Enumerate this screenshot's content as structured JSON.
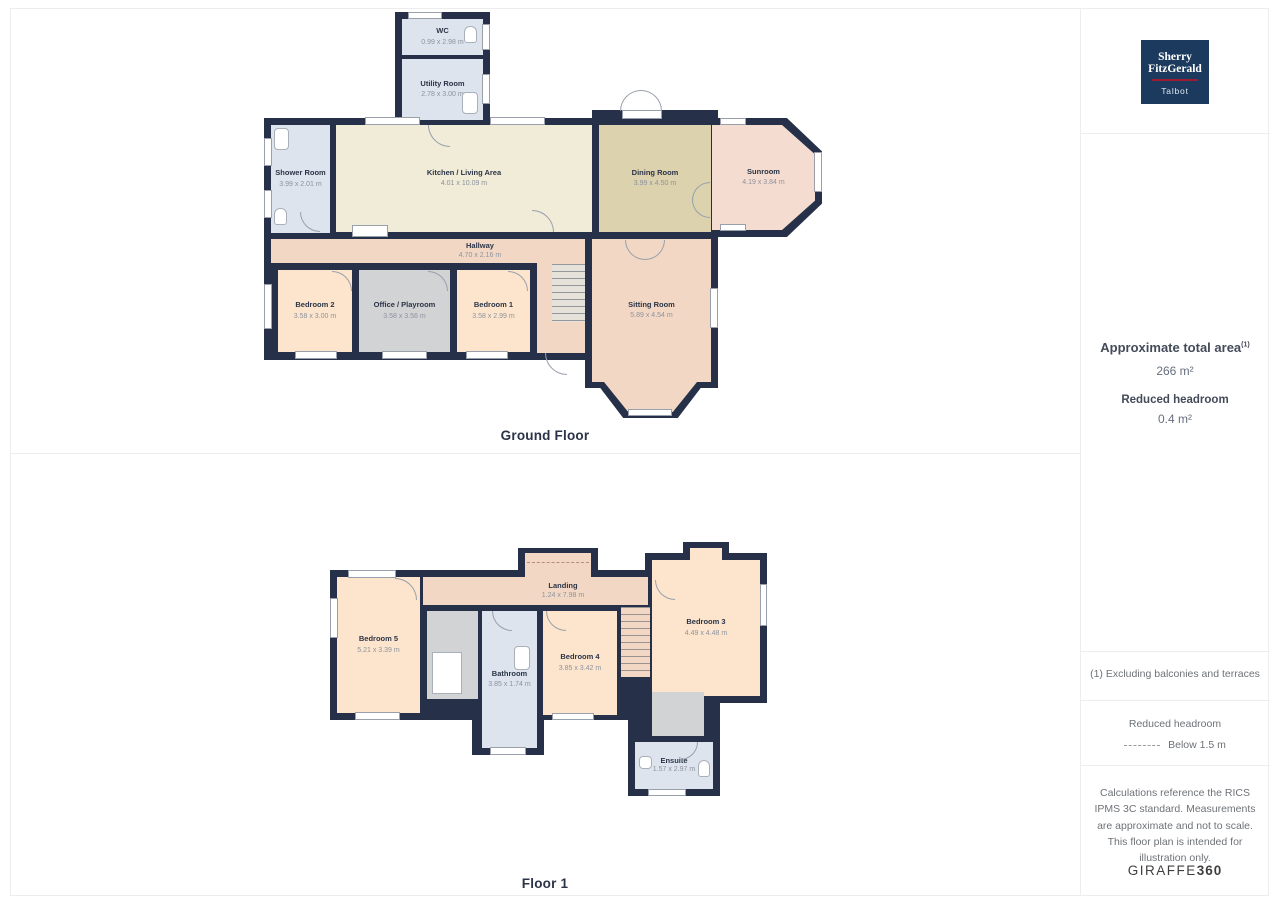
{
  "ground_floor": {
    "label": "Ground Floor",
    "rooms": {
      "wc": {
        "name": "WC",
        "dims": "0.99 x 2.98 m"
      },
      "utility": {
        "name": "Utility Room",
        "dims": "2.78 x 3.00 m"
      },
      "shower": {
        "name": "Shower Room",
        "dims": "3.99 x 2.01 m"
      },
      "kitchen": {
        "name": "Kitchen / Living Area",
        "dims": "4.01 x 10.09 m"
      },
      "dining": {
        "name": "Dining Room",
        "dims": "3.99 x 4.50 m"
      },
      "sunroom": {
        "name": "Sunroom",
        "dims": "4.19 x 3.84 m"
      },
      "hallway": {
        "name": "Hallway",
        "dims": "4.70 x 2.16 m"
      },
      "bedroom2": {
        "name": "Bedroom 2",
        "dims": "3.58 x 3.00 m"
      },
      "office": {
        "name": "Office / Playroom",
        "dims": "3.58 x 3.56 m"
      },
      "bedroom1": {
        "name": "Bedroom 1",
        "dims": "3.58 x 2.99 m"
      },
      "sitting": {
        "name": "Sitting Room",
        "dims": "5.89 x 4.54 m"
      }
    }
  },
  "floor1": {
    "label": "Floor 1",
    "rooms": {
      "bedroom5": {
        "name": "Bedroom 5",
        "dims": "5.21 x 3.39 m"
      },
      "landing": {
        "name": "Landing",
        "dims": "1.24 x 7.98 m"
      },
      "bathroom": {
        "name": "Bathroom",
        "dims": "3.85 x 1.74 m"
      },
      "bedroom4": {
        "name": "Bedroom 4",
        "dims": "3.85 x 3.42 m"
      },
      "bedroom3": {
        "name": "Bedroom 3",
        "dims": "4.49 x 4.48 m"
      },
      "ensuite": {
        "name": "Ensuite",
        "dims": "1.57 x 2.97 m"
      }
    }
  },
  "sidebar": {
    "logo": {
      "line1": "Sherry",
      "line2": "FitzGerald",
      "line3": "Talbot"
    },
    "area_title": "Approximate total area",
    "area_footnote_marker": "(1)",
    "area_value": "266 m²",
    "reduced_headroom_title": "Reduced headroom",
    "reduced_headroom_value": "0.4 m²",
    "footnote": "(1) Excluding balconies and terraces",
    "legend_title": "Reduced headroom",
    "legend_label": "Below 1.5 m",
    "disclaimer": "Calculations reference the RICS IPMS 3C standard. Measurements are approximate and not to scale. This floor plan is intended for illustration only.",
    "brand_regular": "GIRAFFE",
    "brand_bold": "360"
  },
  "colors": {
    "wall": "#263149",
    "room_cream": "#f1ecd7",
    "room_khaki": "#dcd2ae",
    "room_pink": "#f5dcd0",
    "room_salmon": "#f2d8c4",
    "room_peach": "#fce5cc",
    "room_gray": "#d2d3d4",
    "room_blue": "#dde4ee",
    "logo_navy": "#1c3a5e",
    "logo_red": "#9e1b32"
  }
}
